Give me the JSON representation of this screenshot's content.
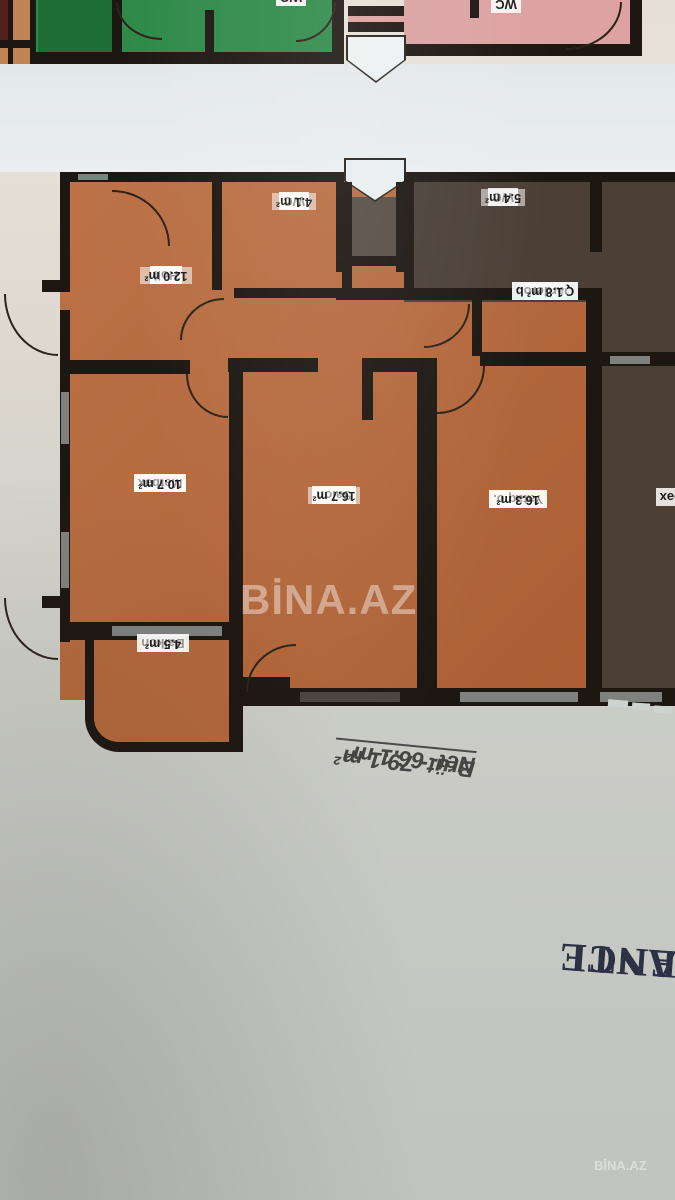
{
  "photo": {
    "type": "floor-plan-photo",
    "orientation": "upside-down"
  },
  "watermarks": {
    "center": "BİNA.AZ",
    "corner": "BİNA.AZ"
  },
  "apartment_orange": {
    "rooms": {
      "hol": {
        "name": "Holl",
        "area": "12.0 m²"
      },
      "wc": {
        "name": "WC",
        "area": "4.1 m²"
      },
      "qarderob": {
        "name": "Qarderob",
        "area": "1.8 m²"
      },
      "metbex": {
        "name": "Mətbəx",
        "area": "10.7 m²"
      },
      "salon": {
        "name": "Salon",
        "area": "16.7 m²"
      },
      "yataq": {
        "name": "Yataq o.",
        "area": "16.3 m²"
      },
      "balkon": {
        "name": "Balkon",
        "area": "4.5 m²"
      }
    },
    "totals": {
      "brut": "Brüt- 79.1 m²",
      "net": "Net- 66.1 m²"
    }
  },
  "apartment_dark": {
    "rooms": {
      "wc": {
        "name": "WC",
        "area": "5.4 m²"
      },
      "metbex_partial": {
        "name": "Mətbəx"
      }
    }
  },
  "upper_floor": {
    "green_wc": "WC",
    "pink_wc": "WC"
  },
  "building_name": {
    "line1": "ANTI",
    "line2": "ENCE"
  },
  "colors": {
    "terracotta": "#b2663a",
    "dark_unit": "#4b3f36",
    "green_unit": "#2e8a49",
    "pink_unit": "#dda2a2",
    "wall": "#1d1712",
    "corridor": "#e7ebec",
    "paper_top": "#e5e0d7",
    "paper_bottom": "#c2c4c0",
    "building_name_text": "#2d3146",
    "totals_text": "#454545"
  }
}
